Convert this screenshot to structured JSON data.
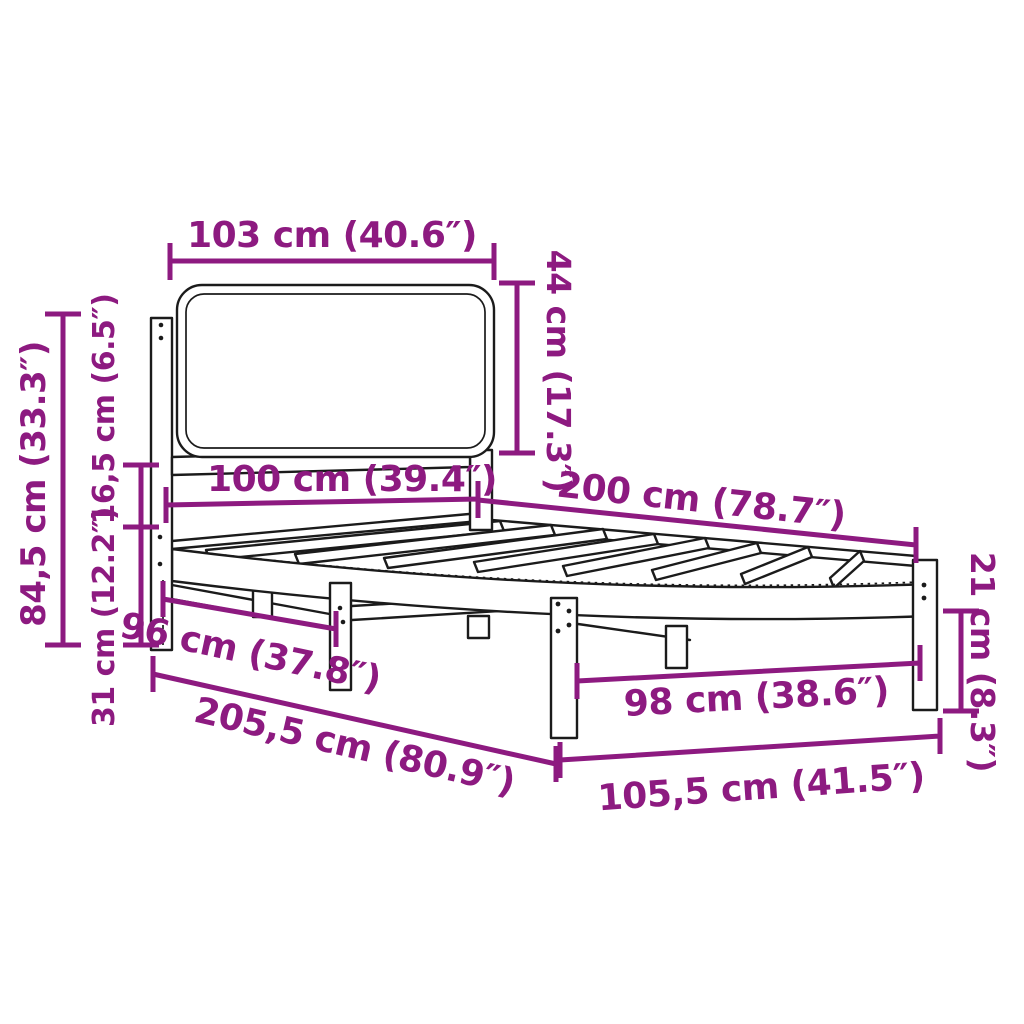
{
  "diagram": {
    "kind": "bed-frame-dimension-diagram",
    "background_color": "#ffffff",
    "drawing_color": "#1b1b1b",
    "accent_color": "#8d1a80",
    "dims": {
      "headboard_width": "103 cm (40.6″)",
      "headboard_height": "44 cm (17.3″)",
      "bed_width": "100 cm (39.4″)",
      "bed_length": "200 cm (78.7″)",
      "total_height": "84,5 cm (33.3″)",
      "rail_section_height": "16,5 cm (6.5″)",
      "clearance_height": "31 cm (12.2″)",
      "inner_width": "96 cm (37.8″)",
      "outer_length": "205,5 cm (80.9″)",
      "inner_leg_span": "98 cm (38.6″)",
      "outer_width": "105,5 cm (41.5″)",
      "leg_height": "21 cm (8.3″)"
    }
  }
}
